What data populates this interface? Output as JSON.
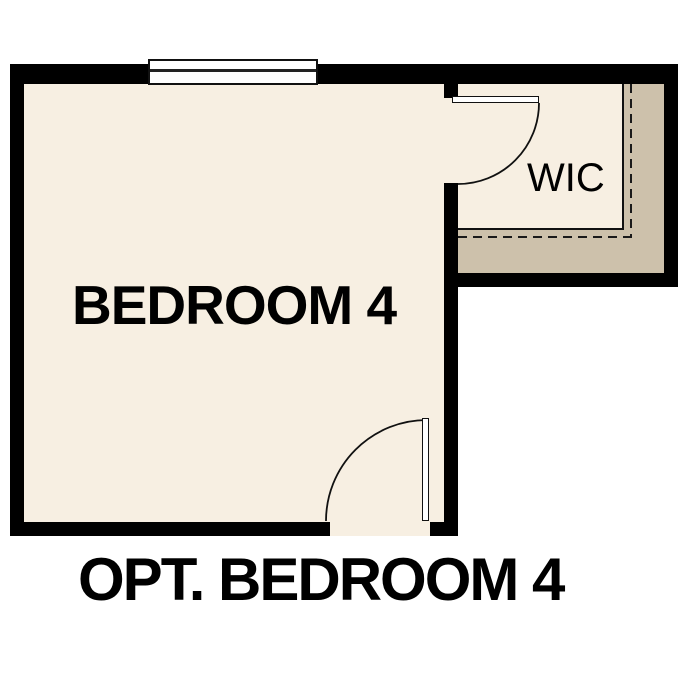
{
  "plan": {
    "rooms": [
      {
        "id": "bedroom-4",
        "label": "BEDROOM 4"
      },
      {
        "id": "wic",
        "label": "WIC"
      }
    ],
    "caption": "OPT. BEDROOM 4"
  },
  "symbols": {
    "window": "window-symbol",
    "doors": [
      "wic-swing-door",
      "bedroom-entry-swing-door"
    ],
    "dashed_outline": "closet-offset-dashed-line"
  },
  "colors": {
    "wall": "#000000",
    "floor": "#f7efe2",
    "closet_band": "#cdc1ab",
    "line": "#111111",
    "background": "#ffffff",
    "text": "#000000"
  }
}
